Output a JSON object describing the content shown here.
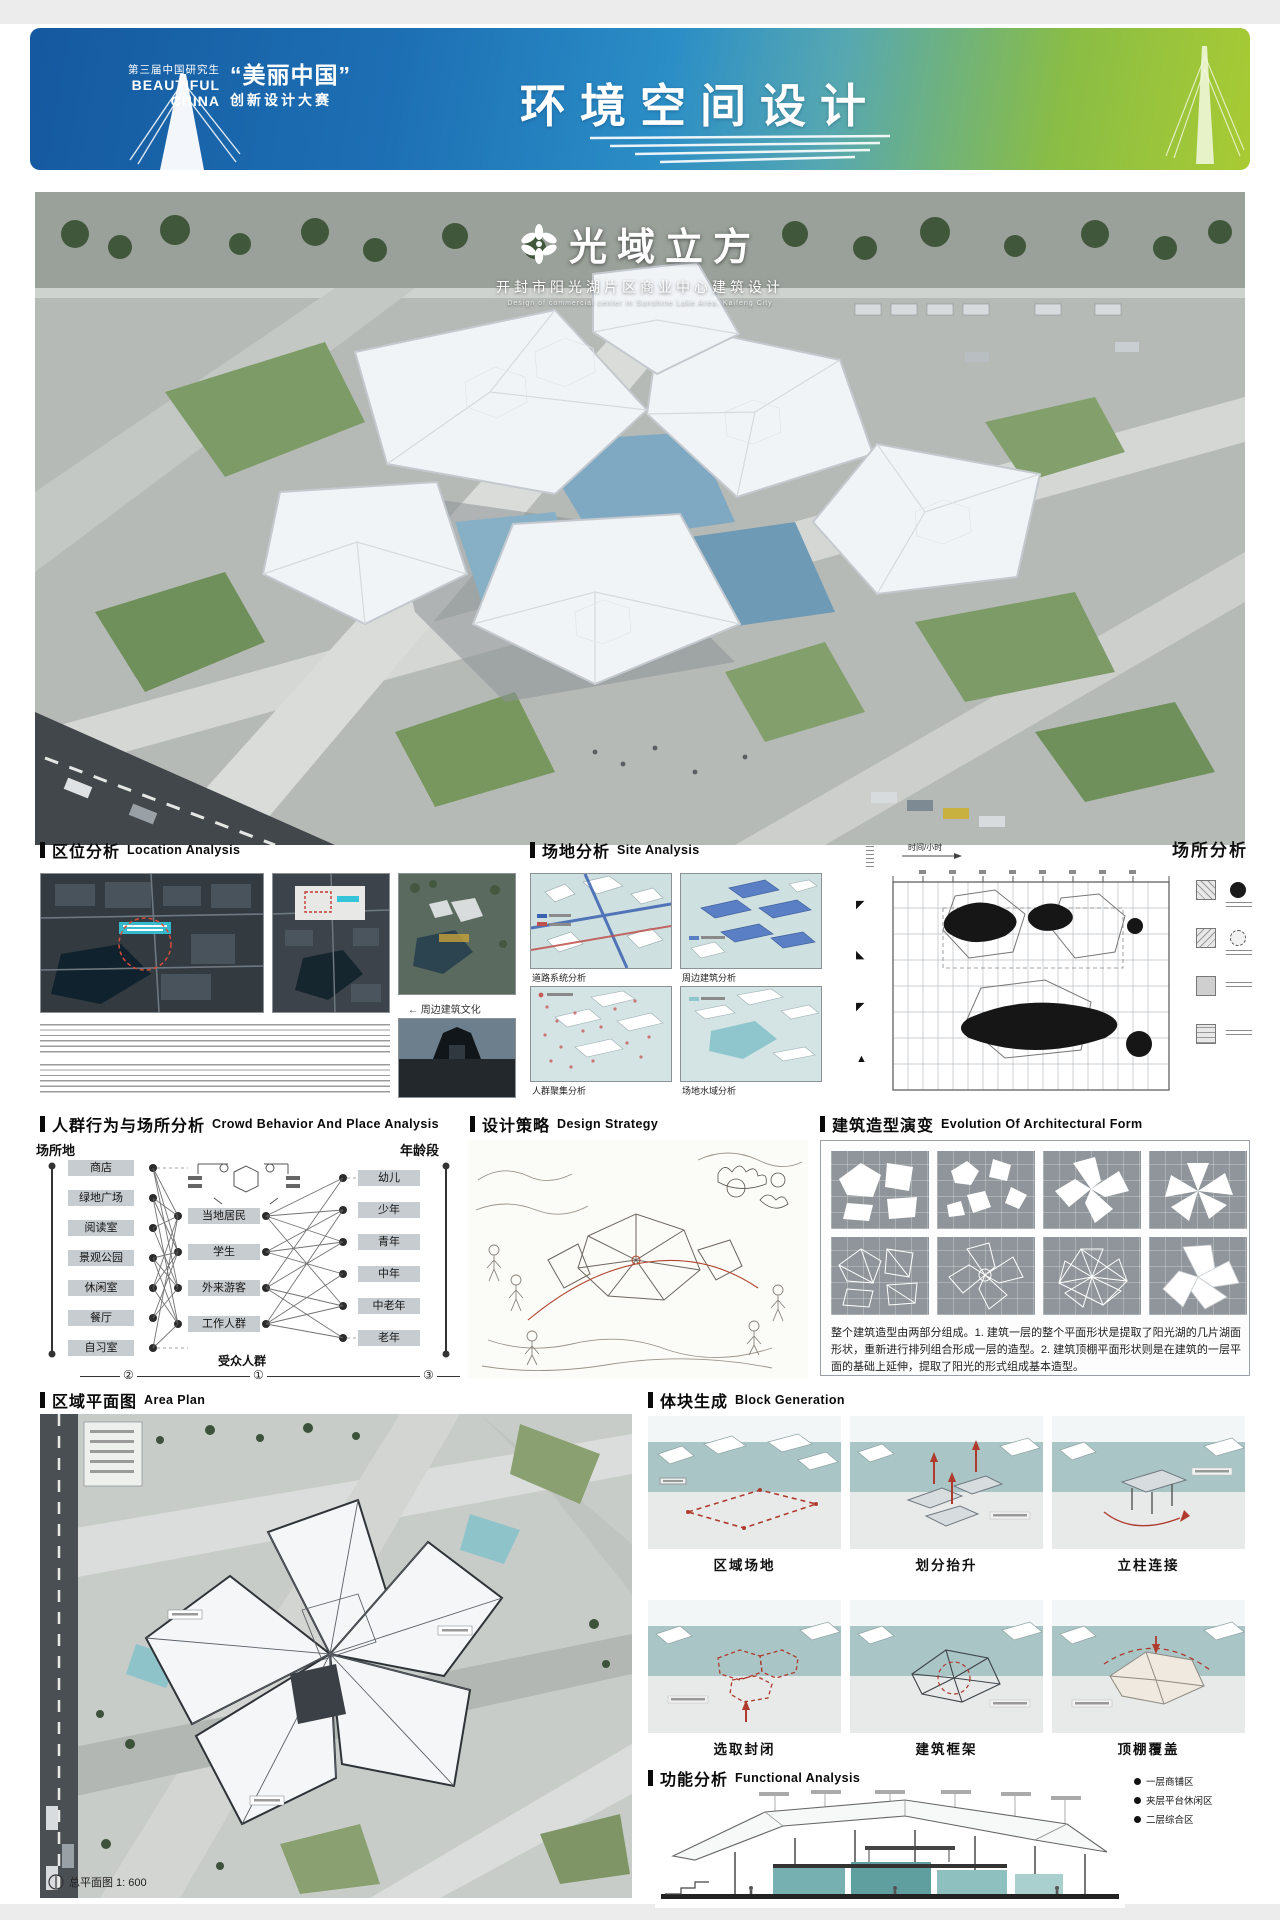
{
  "colors": {
    "banner_blue": "#15599f",
    "banner_green": "#a9cb33",
    "teal_band": "#a9c5c5",
    "accent_red": "#b03a2e",
    "pale_water": "#cfe0e0",
    "section_teal": "#6fb0b0"
  },
  "icons": {
    "project_logo": "flower-icon",
    "legend_bullet": "dot-icon",
    "north_badge": "circle-icon"
  },
  "banner": {
    "org_line": "第三届中国研究生",
    "brand_zh": "“美丽中国”",
    "brand_en_1": "BEAUTIFUL",
    "brand_en_2": "CHINA",
    "event_line": "创新设计大赛",
    "title": "环境空间设计"
  },
  "hero": {
    "title": "光域立方",
    "subtitle_zh": "开封市阳光湖片区商业中心建筑设计",
    "subtitle_en": "Design of commercial center in Sunshine Lake Area, Kaifeng City"
  },
  "location": {
    "h_zh": "区位分析",
    "h_en": "Location Analysis",
    "caption": "← 周边建筑文化"
  },
  "site": {
    "h_zh": "场地分析",
    "h_en": "Site Analysis",
    "captions": [
      "道路系统分析",
      "周边建筑分析",
      "人群聚集分析",
      "场地水域分析"
    ]
  },
  "place": {
    "h_zh": "场所分析",
    "time_label": "时间/小时"
  },
  "crowd": {
    "h_zh": "人群行为与场所分析",
    "h_en": "Crowd Behavior And Place Analysis",
    "axis_left": "场所地",
    "axis_right": "年龄段",
    "places": [
      "商店",
      "绿地广场",
      "阅读室",
      "景观公园",
      "休闲室",
      "餐厅",
      "自习室"
    ],
    "groups": [
      "当地居民",
      "学生",
      "外来游客",
      "工作人群"
    ],
    "groups_label": "受众人群",
    "ages": [
      "幼儿",
      "少年",
      "青年",
      "中年",
      "中老年",
      "老年"
    ],
    "markers": [
      "②",
      "①",
      "③"
    ]
  },
  "strategy": {
    "h_zh": "设计策略",
    "h_en": "Design Strategy"
  },
  "evolution": {
    "h_zh": "建筑造型演变",
    "h_en": "Evolution Of Architectural Form",
    "caption": "整个建筑造型由两部分组成。1. 建筑一层的整个平面形状是提取了阳光湖的几片湖面形状，重新进行排列组合形成一层的造型。2. 建筑顶棚平面形状则是在建筑的一层平面的基础上延伸，提取了阳光的形式组成基本造型。"
  },
  "areaplan": {
    "h_zh": "区域平面图",
    "h_en": "Area Plan",
    "scale_label": "总平面图 1: 600"
  },
  "blocks": {
    "h_zh": "体块生成",
    "h_en": "Block Generation",
    "steps": [
      "区域场地",
      "划分抬升",
      "立柱连接",
      "选取封闭",
      "建筑框架",
      "顶棚覆盖"
    ]
  },
  "functional": {
    "h_zh": "功能分析",
    "h_en": "Functional Analysis",
    "legend": [
      "一层商铺区",
      "夹层平台休闲区",
      "二层综合区"
    ]
  }
}
